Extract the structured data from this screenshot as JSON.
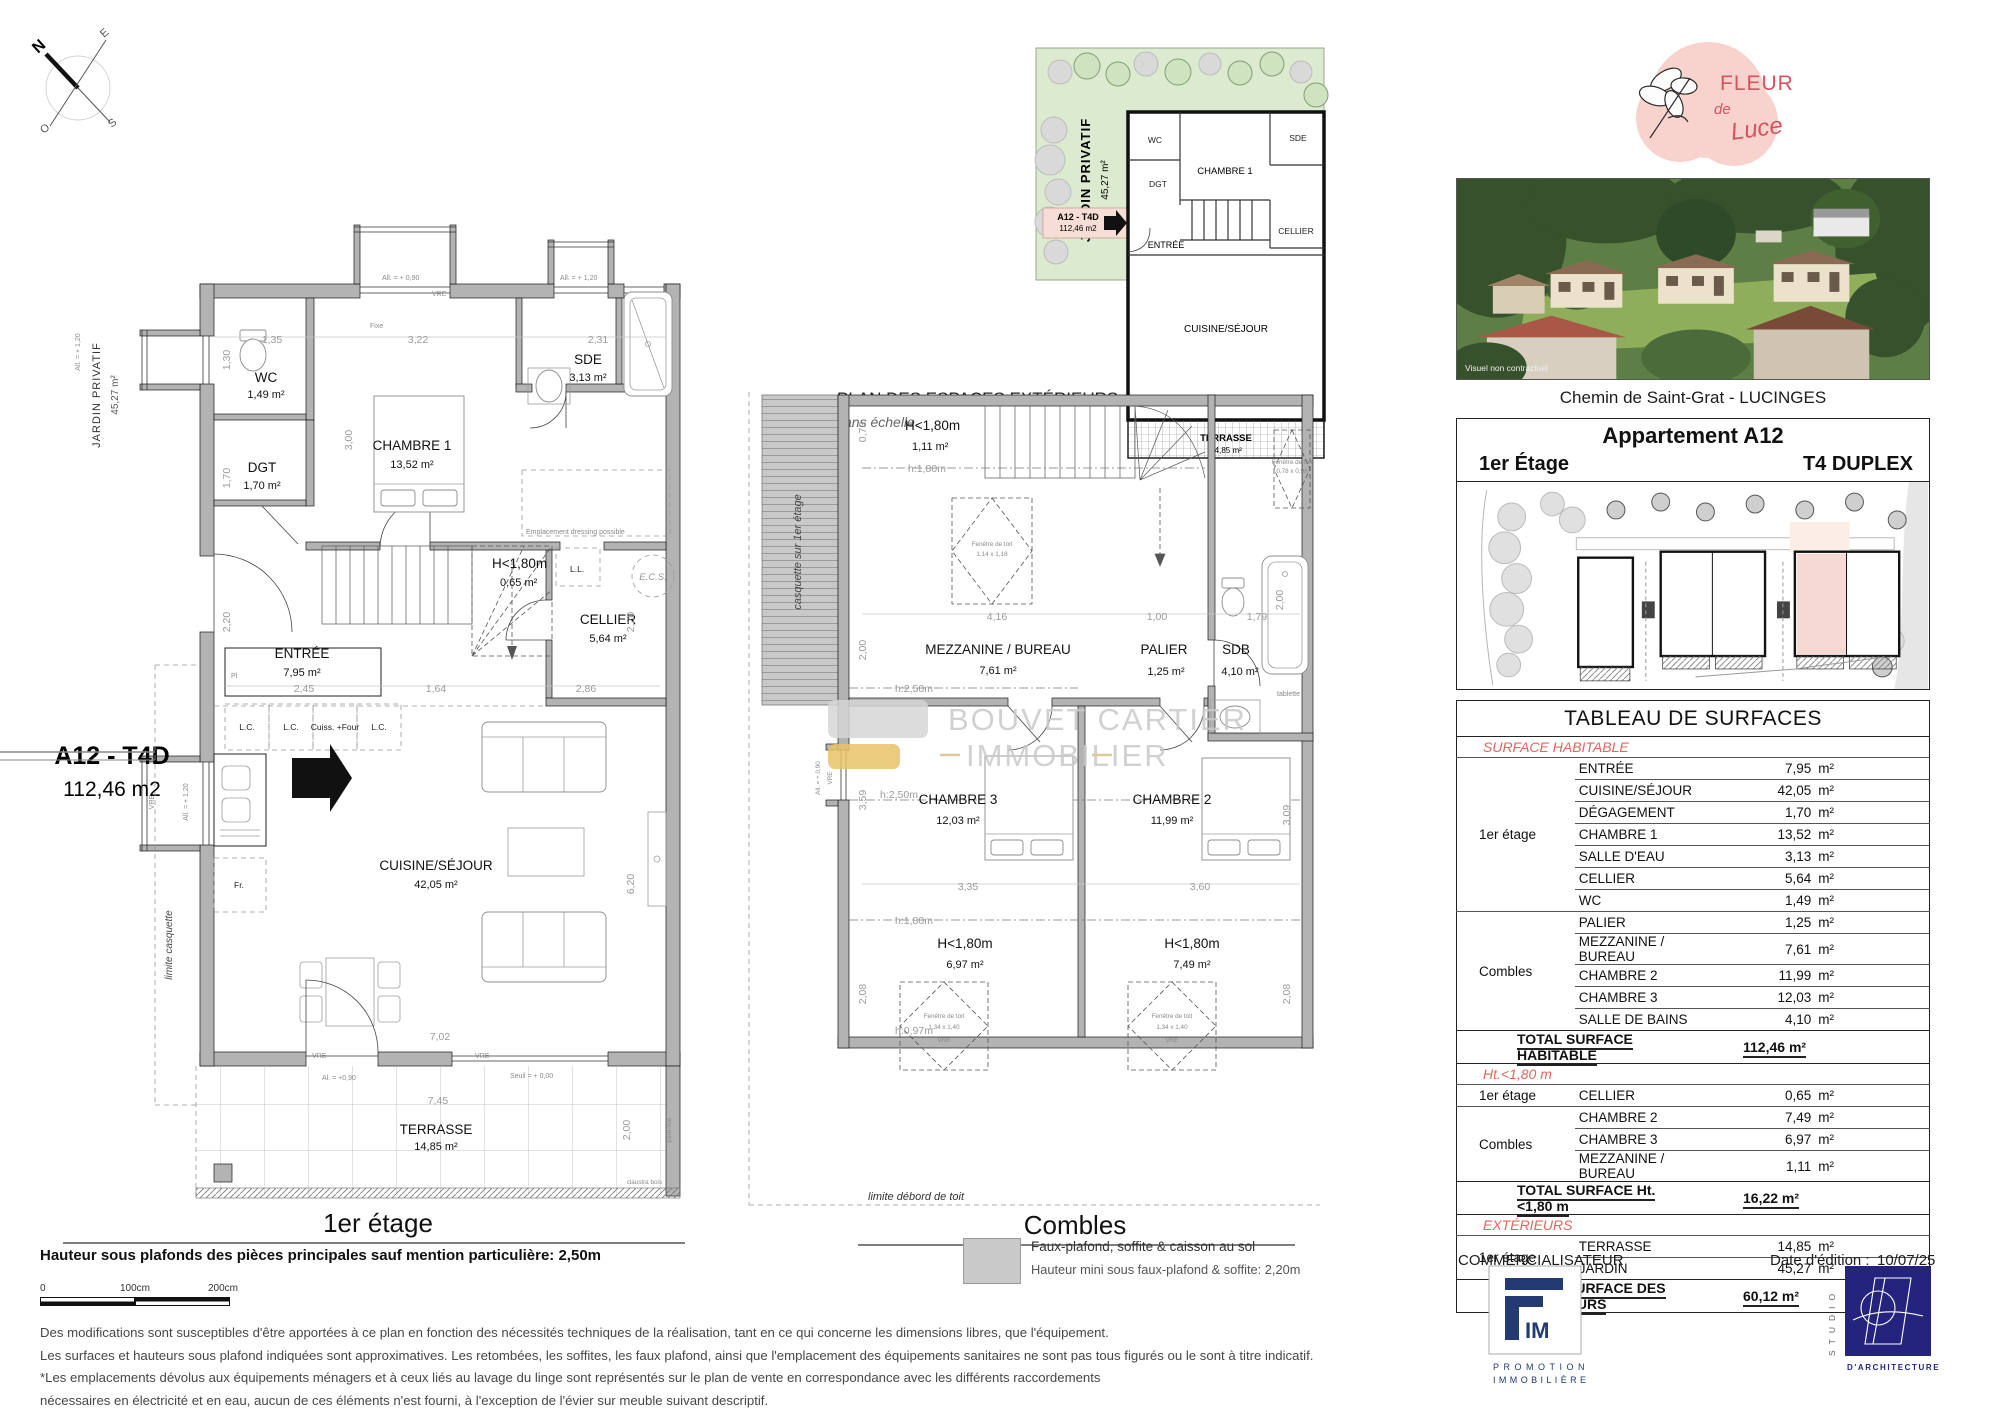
{
  "compass": {
    "n": "N",
    "e": "E",
    "s": "S",
    "o": "O"
  },
  "common": {
    "vre": "VRE",
    "h_lt_180": "H<1,80m",
    "fenetre_toit": "Fenêtre de toit"
  },
  "plan1": {
    "title": "1er étage",
    "jardin_privatif": "JARDIN PRIVATIF",
    "jardin_area": "45,27 m²",
    "unit_code": "A12 - T4D",
    "unit_area": "112,46 m2",
    "limite_casquette": "limite casquette",
    "all_090": "All. = + 0,90",
    "all_120": "All. = + 1,20",
    "fixe": "Fixe",
    "wc": "WC",
    "wc_area": "1,49 m²",
    "dgt": "DGT",
    "dgt_area": "1,70 m²",
    "chambre1": "CHAMBRE 1",
    "chambre1_area": "13,52 m²",
    "sde": "SDE",
    "sde_area": "3,13 m²",
    "cellier": "CELLIER",
    "cellier_area": "5,64 m²",
    "entree": "ENTRÉE",
    "entree_area": "7,95 m²",
    "cuisine": "CUISINE/SÉJOUR",
    "cuisine_area": "42,05 m²",
    "terrasse": "TERRASSE",
    "terrasse_area": "14,85 m²",
    "h180_area": "0,65 m²",
    "ll": "L.L.",
    "ecs": "E.C.S.",
    "dressing": "Emplacement dressing possible",
    "pl": "Pl",
    "lc": "L.C.",
    "cuiss_four": "Cuiss. +Four",
    "fr": "Fr.",
    "claustra": "claustra bois",
    "pare_vue": "pare-vue",
    "al_090": "Al. = +0,90",
    "seuil": "Seuil = + 0,00",
    "dims": {
      "w135": "1,35",
      "w322": "3,22",
      "w231": "2,31",
      "h130": "1,30",
      "h300": "3,00",
      "h170": "1,70",
      "h220": "2,20",
      "w245": "2,45",
      "w164": "1,64",
      "w286": "2,86",
      "h620": "6,20",
      "w702": "7,02",
      "w745": "7,45",
      "h200": "2,00"
    }
  },
  "plan_ext": {
    "heading": "PLAN DES ESPACES EXTÉRIEURS",
    "subheading": "sans échelle"
  },
  "plan2": {
    "title": "Combles",
    "casquette": "casquette sur 1er étage",
    "area_111": "1,11 m²",
    "h180": "h:1,80m",
    "h250": "h:2,50m",
    "h097": "h:0,97m",
    "mezzanine": "MEZZANINE / BUREAU",
    "mezzanine_area": "7,61 m²",
    "palier": "PALIER",
    "palier_area": "1,25 m²",
    "sdb": "SDB",
    "sdb_area": "4,10 m²",
    "tablette": "tablette",
    "chambre3": "CHAMBRE 3",
    "chambre3_area": "12,03 m²",
    "chambre2": "CHAMBRE 2",
    "chambre2_area": "11,99 m²",
    "area_697": "6,97 m²",
    "area_749": "7,49 m²",
    "fen_114": "1,14 x 1,18",
    "fen_078": "0,78 x 0,98",
    "fen_134": "1,34 x 1,40",
    "all_090": "All. = + 0,90",
    "limite_debord": "limite débord de toit",
    "dims": {
      "h073": "0,73",
      "h200": "2,00",
      "w416": "4,16",
      "w100": "1,00",
      "w179": "1,79",
      "h359": "3,59",
      "w335": "3,35",
      "w360": "3,60",
      "h309": "3,09",
      "h208": "2,08"
    }
  },
  "watermark": {
    "line1": "BOUVET CARTIER",
    "line2": "IMMOBILIER"
  },
  "notes": {
    "hauteur": "Hauteur sous plafonds des pièces principales sauf mention particulière: 2,50m",
    "scale_labels": [
      "0",
      "100cm",
      "200cm"
    ],
    "disclaimer": [
      "Des modifications sont susceptibles d'être apportées à ce plan en fonction des nécessités techniques de la réalisation, tant en ce qui concerne les dimensions libres, que l'équipement.",
      "Les surfaces et hauteurs sous plafond indiquées sont approximatives. Les retombées, les soffites, les faux plafond, ainsi que l'emplacement des équipements sanitaires ne sont pas tous figurés ou le sont à titre indicatif.",
      "*Les emplacements dévolus aux équipements ménagers et à ceux liés au lavage du linge sont représentés sur le plan de vente en correspondance avec les différents raccordements",
      "nécessaires en électricité et en eau, aucun de ces éléments n'est fourni, à l'exception de l'évier sur meuble suivant descriptif."
    ]
  },
  "legend": {
    "line1": "Faux-plafond, soffite & caisson au sol",
    "line2": "Hauteur mini sous faux-plafond & soffite: 2,20m"
  },
  "panel": {
    "brand": {
      "word1": "FLEUR",
      "word2": "de",
      "word3": "Luce"
    },
    "photo_caption": "Visuel non contractuel",
    "address": "Chemin de Saint-Grat - LUCINGES",
    "apt_title": "Appartement A12",
    "apt_floor": "1er Étage",
    "apt_type": "T4 DUPLEX",
    "commercialisateur": "COMMERCIALISATEUR",
    "date_label": "Date d'édition :",
    "date_value": "10/07/25",
    "fim": {
      "mark": "IM",
      "line1": "PROMOTION",
      "line2": "IMMOBILIÈRE"
    },
    "studio": {
      "vertical": "STUDIO",
      "bottom": "D'ARCHITECTURE"
    }
  },
  "surface_table": {
    "title": "TABLEAU DE SURFACES",
    "unit": "m²",
    "sections": [
      {
        "header": "SURFACE HABITABLE",
        "groups": [
          {
            "label": "1er étage",
            "rows": [
              {
                "room": "ENTRÉE",
                "area": "7,95"
              },
              {
                "room": "CUISINE/SÉJOUR",
                "area": "42,05"
              },
              {
                "room": "DÉGAGEMENT",
                "area": "1,70"
              },
              {
                "room": "CHAMBRE 1",
                "area": "13,52"
              },
              {
                "room": "SALLE D'EAU",
                "area": "3,13"
              },
              {
                "room": "CELLIER",
                "area": "5,64"
              },
              {
                "room": "WC",
                "area": "1,49"
              }
            ]
          },
          {
            "label": "Combles",
            "rows": [
              {
                "room": "PALIER",
                "area": "1,25"
              },
              {
                "room": "MEZZANINE / BUREAU",
                "area": "7,61"
              },
              {
                "room": "CHAMBRE 2",
                "area": "11,99"
              },
              {
                "room": "CHAMBRE 3",
                "area": "12,03"
              },
              {
                "room": "SALLE DE BAINS",
                "area": "4,10"
              }
            ]
          }
        ],
        "total_label": "TOTAL SURFACE HABITABLE",
        "total_value": "112,46 m²"
      },
      {
        "header": "Ht.<1,80 m",
        "groups": [
          {
            "label": "1er étage",
            "rows": [
              {
                "room": "CELLIER",
                "area": "0,65"
              }
            ]
          },
          {
            "label": "Combles",
            "rows": [
              {
                "room": "CHAMBRE 2",
                "area": "7,49"
              },
              {
                "room": "CHAMBRE 3",
                "area": "6,97"
              },
              {
                "room": "MEZZANINE / BUREAU",
                "area": "1,11"
              }
            ]
          }
        ],
        "total_label": "TOTAL SURFACE Ht. <1,80 m",
        "total_value": "16,22 m²"
      },
      {
        "header": "EXTÉRIEURS",
        "groups": [
          {
            "label": "1er étage",
            "rows": [
              {
                "room": "TERRASSE",
                "area": "14,85"
              },
              {
                "room": "JARDIN",
                "area": "45,27"
              }
            ]
          }
        ],
        "total_label": "TOTAL SURFACE DES EXTÉRIEURS",
        "total_value": "60,12 m²"
      }
    ]
  },
  "colors": {
    "section_red": "#e0655e",
    "jardin_green": "#dcead0",
    "unit_pink": "#f6ddd5",
    "wall_gray": "#b3b3b3",
    "brand_pink": "#f8d3cd",
    "brand_red": "#d4545e",
    "studio_navy": "#24247e",
    "fim_navy": "#233a73"
  }
}
